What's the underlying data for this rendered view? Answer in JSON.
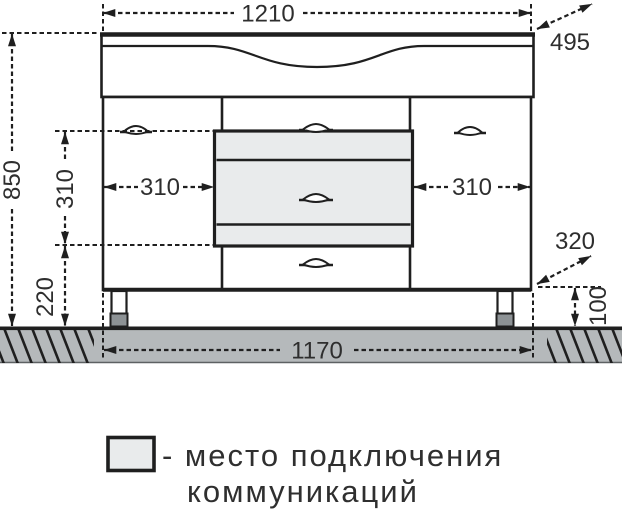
{
  "dimensions": {
    "top_width": "1210",
    "depth": "495",
    "height": "850",
    "offset_left": "310",
    "connection_size": "310",
    "offset_right": "310",
    "bottom_clearance": "220",
    "corner_offset": "320",
    "leg_height": "100",
    "base_width": "1170"
  },
  "legend": {
    "line1": "- место подключения",
    "line2": "коммуникаций"
  },
  "colors": {
    "line": "#1f1f1f",
    "connection_fill": "#e9ebec",
    "ground_fill": "#b5b9bb",
    "foot_fill": "#8d9295",
    "cabinet_fill": "#ffffff"
  }
}
